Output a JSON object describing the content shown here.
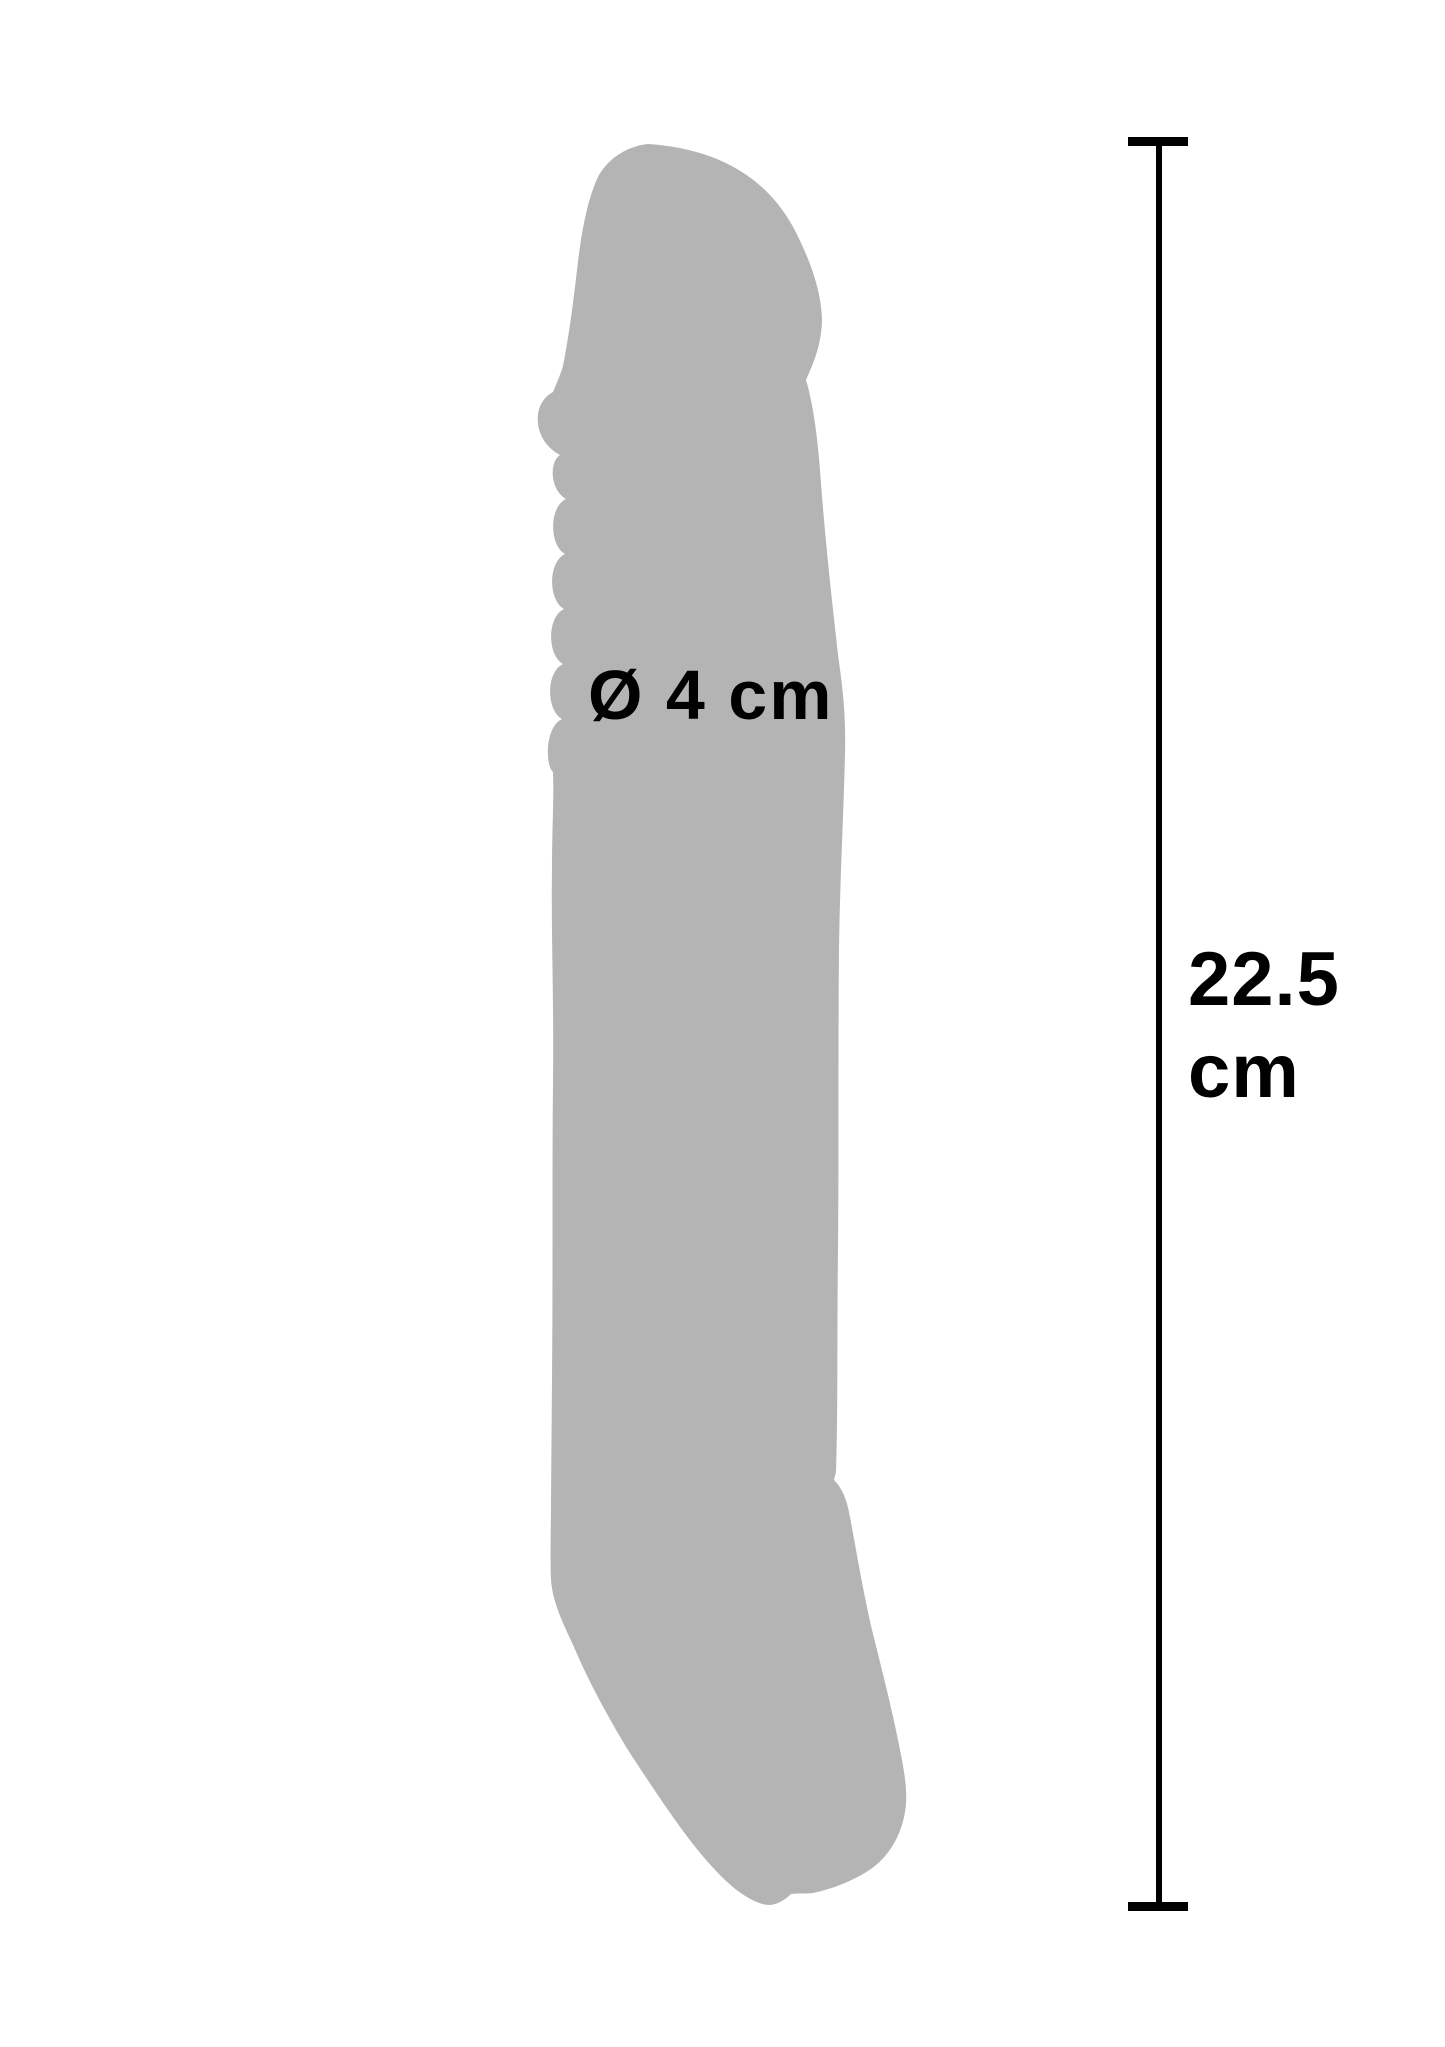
{
  "figure": {
    "silhouette": "penis-extension-sleeve-side-view",
    "diameter_label": "Ø 4 cm",
    "length_value": "22.5",
    "length_unit": "cm"
  },
  "colors": {
    "background": "#ffffff",
    "silhouette": "#b4b4b4",
    "annotation": "#000000"
  }
}
